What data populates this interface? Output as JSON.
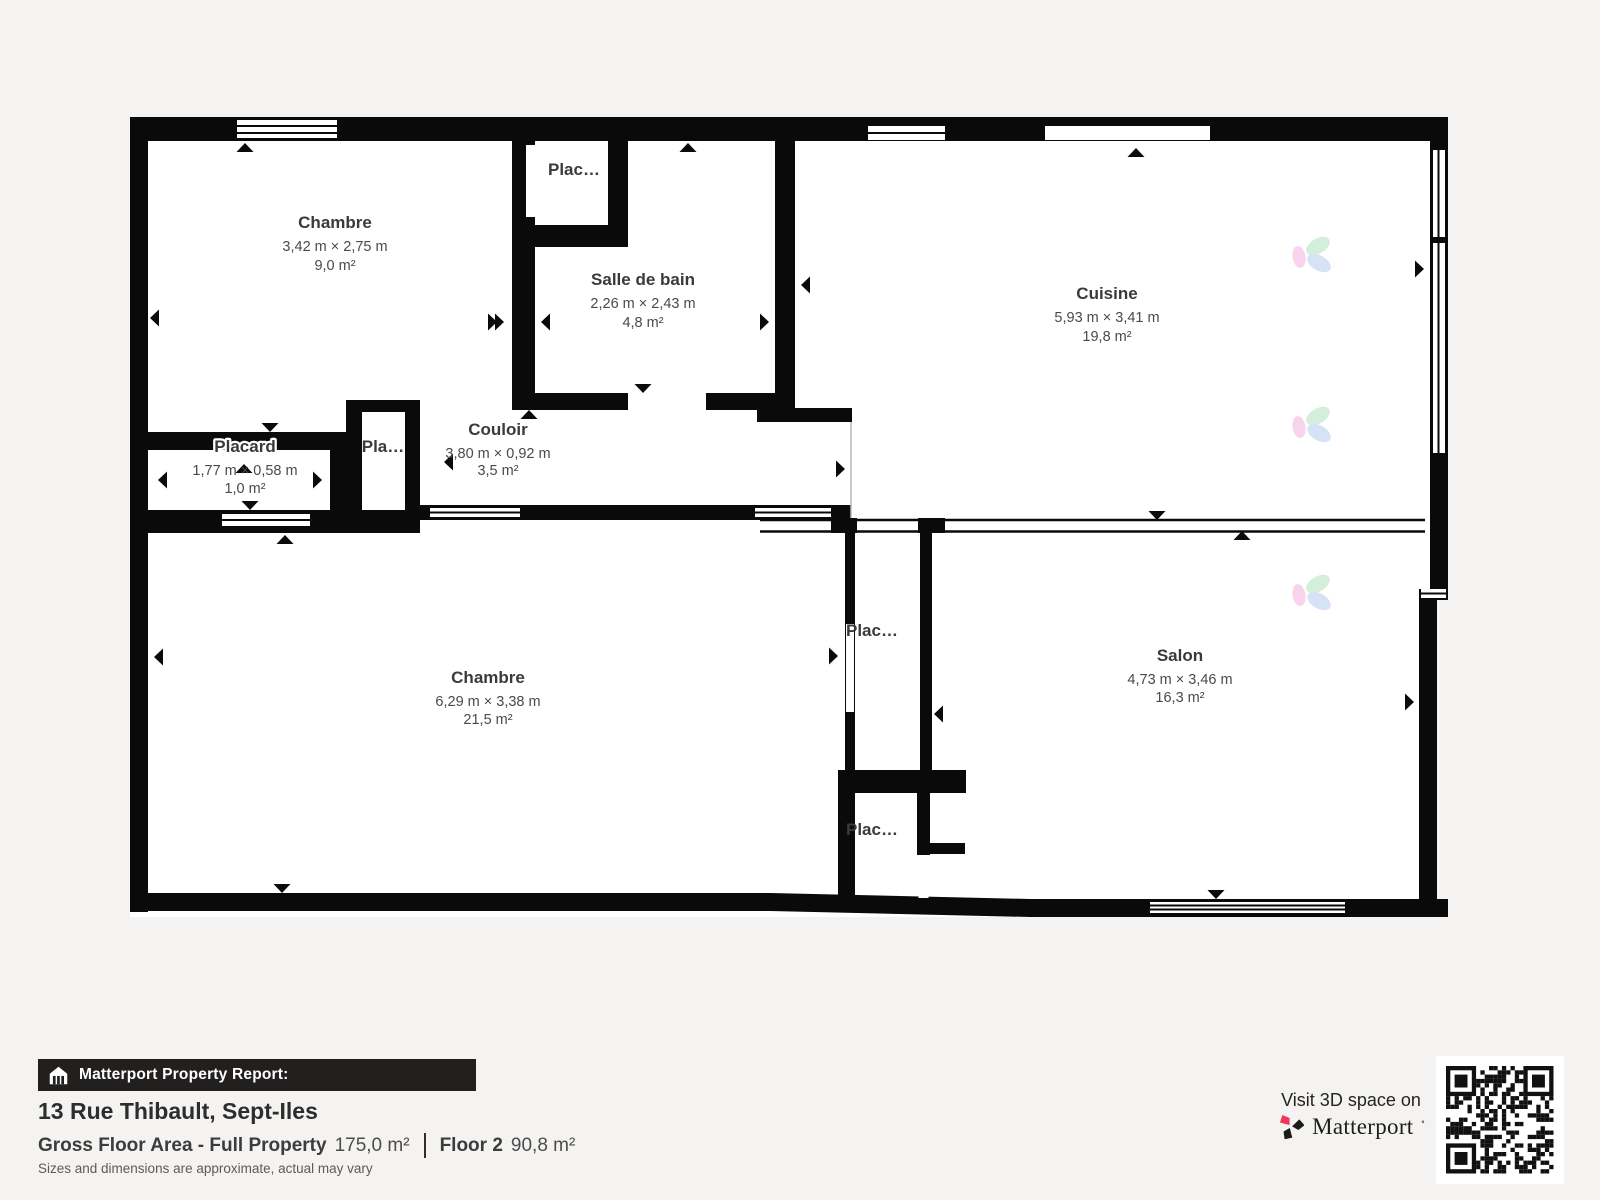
{
  "plan": {
    "rooms": [
      {
        "name": "Chambre",
        "dims": "3,42 m × 2,75 m",
        "area": "9,0 m²"
      },
      {
        "name": "Plac…"
      },
      {
        "name": "Salle de bain",
        "dims": "2,26 m × 2,43 m",
        "area": "4,8 m²"
      },
      {
        "name": "Cuisine",
        "dims": "5,93 m × 3,41 m",
        "area": "19,8 m²"
      },
      {
        "name": "Placard",
        "dims": "1,77 m × 0,58 m",
        "area": "1,0 m²"
      },
      {
        "name": "Pla…"
      },
      {
        "name": "Couloir",
        "dims": "3,80 m × 0,92 m",
        "area": "3,5 m²"
      },
      {
        "name": "Chambre",
        "dims": "6,29 m × 3,38 m",
        "area": "21,5 m²"
      },
      {
        "name": "Plac…"
      },
      {
        "name": "Plac…"
      },
      {
        "name": "Salon",
        "dims": "4,73 m × 3,46 m",
        "area": "16,3 m²"
      }
    ]
  },
  "footer": {
    "report_label": "Matterport Property Report:",
    "address": "13 Rue Thibault, Sept-Iles",
    "gfa_label": "Gross Floor Area - Full Property",
    "gfa_value": "175,0 m²",
    "floor_label": "Floor 2",
    "floor_value": "90,8 m²",
    "disclaimer": "Sizes and dimensions are approximate, actual may vary"
  },
  "cta": {
    "visit_text": "Visit 3D space on",
    "brand": "Matterport",
    "trademark_mark": "˚"
  },
  "colors": {
    "background": "#f4f3f1",
    "wall": "#0a0a0a",
    "brand_red": "#f0385c",
    "report_bar": "#221f1f"
  }
}
